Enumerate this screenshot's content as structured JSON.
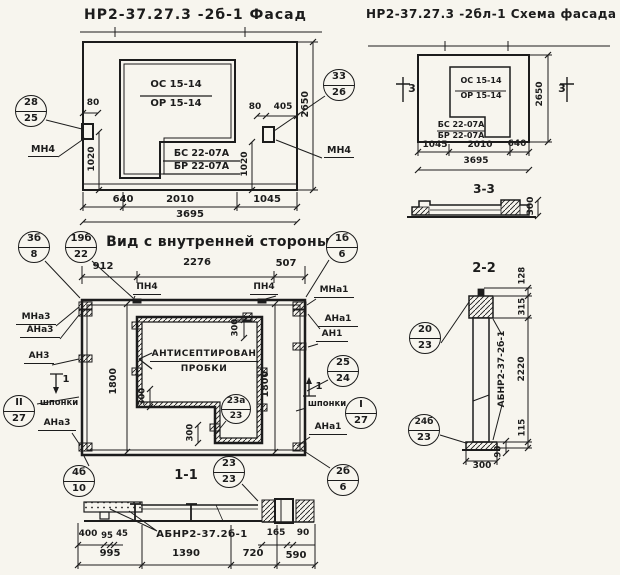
{
  "facade": {
    "title": "НР2-37.27.3 -2б-1 Фасад",
    "window_mark_top": "ОС 15-14",
    "window_mark_bot": "ОР 15-14",
    "apron_mark_top": "БС 22-07А",
    "apron_mark_bot": "БР 22-07А",
    "anchor_left": "МН4",
    "anchor_right": "МН4",
    "callout_left_top": "28",
    "callout_left_bot": "25",
    "callout_right_top": "33",
    "callout_right_bot": "26",
    "dim_80_left": "80",
    "dim_1020_left": "1020",
    "dim_80_right": "80",
    "dim_405": "405",
    "dim_1020_right": "1020",
    "dim_2650": "2650",
    "dim_640": "640",
    "dim_2010": "2010",
    "dim_1045": "1045",
    "dim_3695": "3695"
  },
  "scheme": {
    "title": "НР2-37.27.3 -2бл-1 Схема фасада",
    "window_mark_top": "ОС 15-14",
    "window_mark_bot": "ОР 15-14",
    "apron_mark_top": "БС 22-07А",
    "apron_mark_bot": "БР 22-07А",
    "cut_mark_left": "3",
    "cut_mark_right": "3",
    "dim_1045": "1045",
    "dim_2010": "2010",
    "dim_640": "640",
    "dim_3695": "3695",
    "dim_2650": "2650"
  },
  "section33": {
    "title": "3-3",
    "dim_300": "300"
  },
  "inner": {
    "title": "Вид с внутренней стороны",
    "callout_tl_top": "3б",
    "callout_tl_bot": "8",
    "callout_title_top": "19б",
    "callout_title_bot": "22",
    "callout_tr_top": "1б",
    "callout_tr_bot": "6",
    "dim_912": "912",
    "dim_2276": "2276",
    "dim_507": "507",
    "pn4_left": "ПН4",
    "pn4_right": "ПН4",
    "mna3": "МНа3",
    "ana3_top": "АНа3",
    "an3": "АН3",
    "cut_left": "1",
    "cut_right": "1",
    "shponki_left": "шпонки",
    "callout_sh_left_top": "II",
    "callout_sh_left_bot": "27",
    "ana3_bot": "АНа3",
    "callout_bl_top": "4б",
    "callout_bl_bot": "10",
    "mna1": "МНа1",
    "ana1_top": "АНа1",
    "an1": "АН1",
    "callout_25_top": "25",
    "callout_25_bot": "24",
    "shponki_right": "шпонки",
    "callout_sh_right_top": "I",
    "callout_sh_right_bot": "27",
    "ana1_bot": "АНа1",
    "callout_br_top": "2б",
    "callout_br_bot": "6",
    "antiseptic1": "АНТИСЕПТИРОВАН",
    "antiseptic2": "ПРОБКИ",
    "callout_opening_top": "23а",
    "callout_opening_bot": "23",
    "dim_1800_left": "1800",
    "dim_1800_right": "1800",
    "dim_300_tr": "300",
    "dim_300_ml": "300",
    "dim_300_bc": "300"
  },
  "section11": {
    "title": "1-1",
    "callout_top": "23",
    "callout_bot": "23",
    "part_label": "АБНР2-37.2б-1",
    "dim_400": "400",
    "dim_95": "95",
    "dim_45": "45",
    "dim_165": "165",
    "dim_90": "90",
    "dim_995": "995",
    "dim_1390": "1390",
    "dim_720": "720",
    "dim_590": "590"
  },
  "section22": {
    "title": "2-2",
    "part_label": "АБНР2-37-2б-1",
    "callout_top_top": "20",
    "callout_top_bot": "23",
    "callout_bot_top": "24б",
    "callout_bot_bot": "23",
    "dim_128": "128",
    "dim_315": "315",
    "dim_2220": "2220",
    "dim_115": "115",
    "dim_90": "90",
    "dim_300": "300"
  },
  "colors": {
    "ink": "#1c1c1c",
    "paper": "#f7f5ee"
  }
}
